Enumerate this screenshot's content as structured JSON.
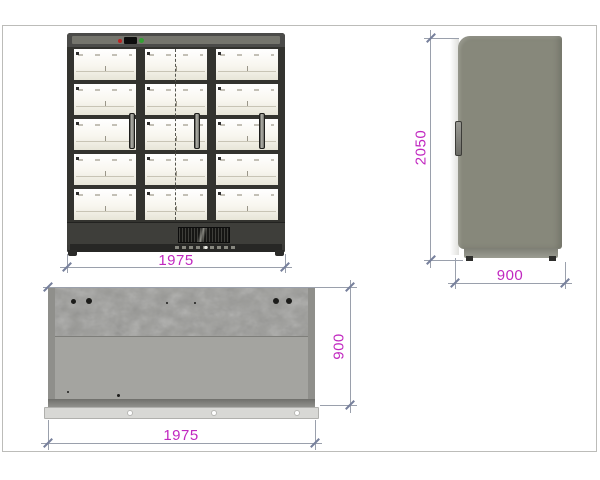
{
  "sheet": {
    "description": "Technical drawing of a three-door refrigerated display cabinet, front / side / top views"
  },
  "dimensions": {
    "front_width_mm": "1975",
    "height_mm": "2050",
    "side_depth_mm": "900",
    "top_depth_mm": "900",
    "top_width_mm": "1975"
  },
  "colors": {
    "dimension_text": "#c128c0",
    "dimension_line": "#9aa0ac",
    "cabinet_frame": "#3b3b38",
    "shelf_interior": "#f8f6ef",
    "side_panel": "#87887b",
    "top_panel": "#9e9e9a",
    "status_led_red": "#bb2222",
    "status_led_green": "#33a033"
  },
  "icons": {
    "grille": "ventilation-grille",
    "leds": [
      "red-status-led",
      "green-status-led"
    ]
  }
}
